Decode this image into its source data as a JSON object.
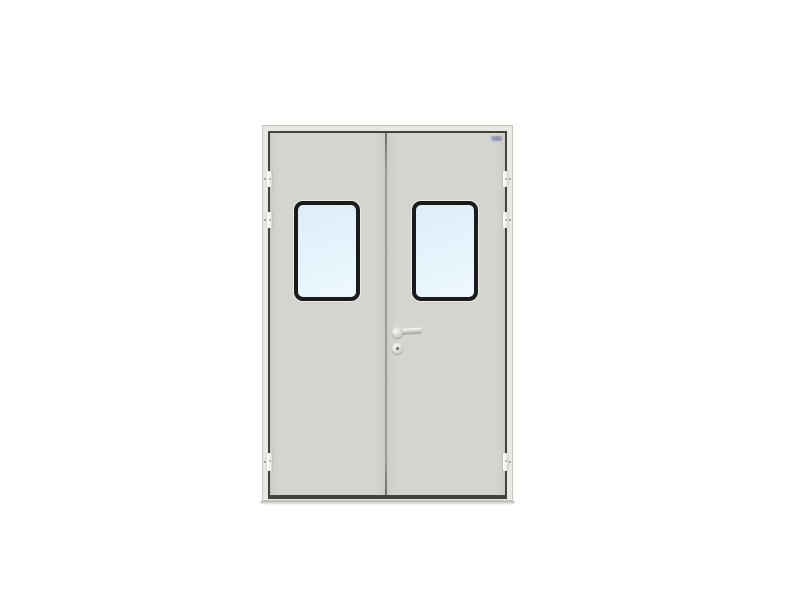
{
  "image": {
    "type": "product-photo",
    "subject": "Light-gray double swing door (cleanroom style) with two rounded vision windows, lever handle with keyhole escutcheon, three hinges per side, on a plain white background",
    "visible_text": ""
  },
  "door": {
    "leaf_count": 2,
    "window_count": 2,
    "hinges_per_side": 3,
    "hardware": {
      "handle": "lever handle on right leaf beside center seam",
      "lock": "round escutcheon with keyhole below the handle"
    }
  },
  "colors": {
    "background": "#ffffff",
    "frame": "#e9e9e4",
    "frame_edge": "#c6c6c1",
    "leaf": "#d4d5cf",
    "leaf_shade": "#cbccc6",
    "gap_line": "#42423e",
    "seam_line": "#9c9c96",
    "window_frame": "#1b1b1b",
    "glass_top": "#dceefa",
    "glass_bottom": "#eef8fe",
    "hinge": "#f3f3ef",
    "shadow": "#787873"
  }
}
